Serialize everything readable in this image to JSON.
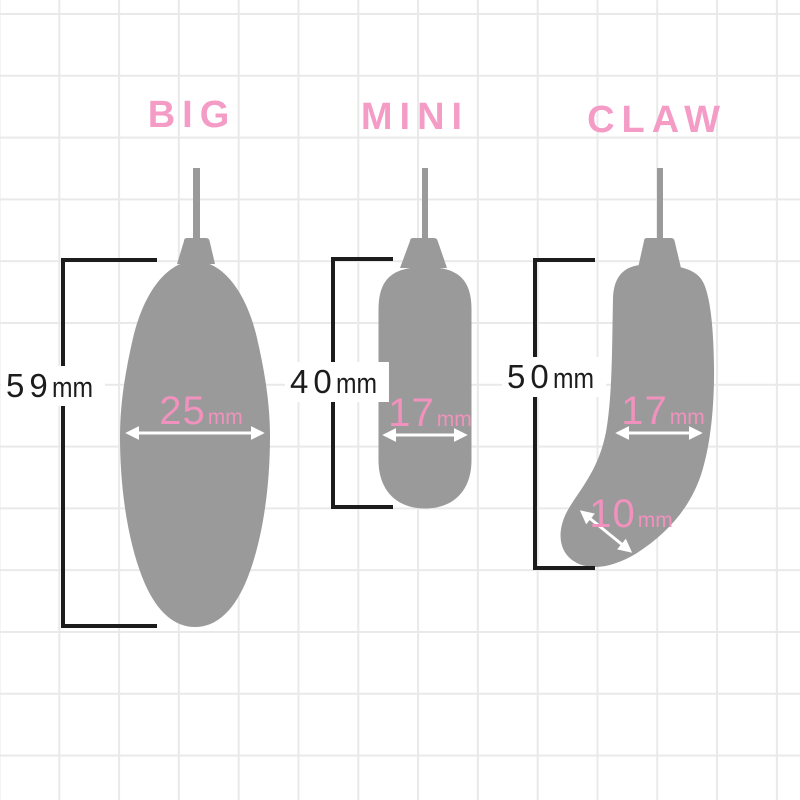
{
  "colors": {
    "pink_title": "#f49cc6",
    "pink_value": "#f191bd",
    "silhouette_gray": "#9a9a9a",
    "measure_ink": "#1c1c1c",
    "grid_line": "#e9e9e9",
    "paper": "#ffffff"
  },
  "products": [
    {
      "title": "BIG",
      "height": {
        "value": "59",
        "unit": "mm"
      },
      "width": {
        "value": "25",
        "unit": "mm"
      }
    },
    {
      "title": "MINI",
      "height": {
        "value": "40",
        "unit": "mm"
      },
      "width": {
        "value": "17",
        "unit": "mm"
      }
    },
    {
      "title": "CLAW",
      "height": {
        "value": "50",
        "unit": "mm"
      },
      "width": {
        "value": "17",
        "unit": "mm"
      },
      "tip": {
        "value": "10",
        "unit": "mm"
      }
    }
  ]
}
